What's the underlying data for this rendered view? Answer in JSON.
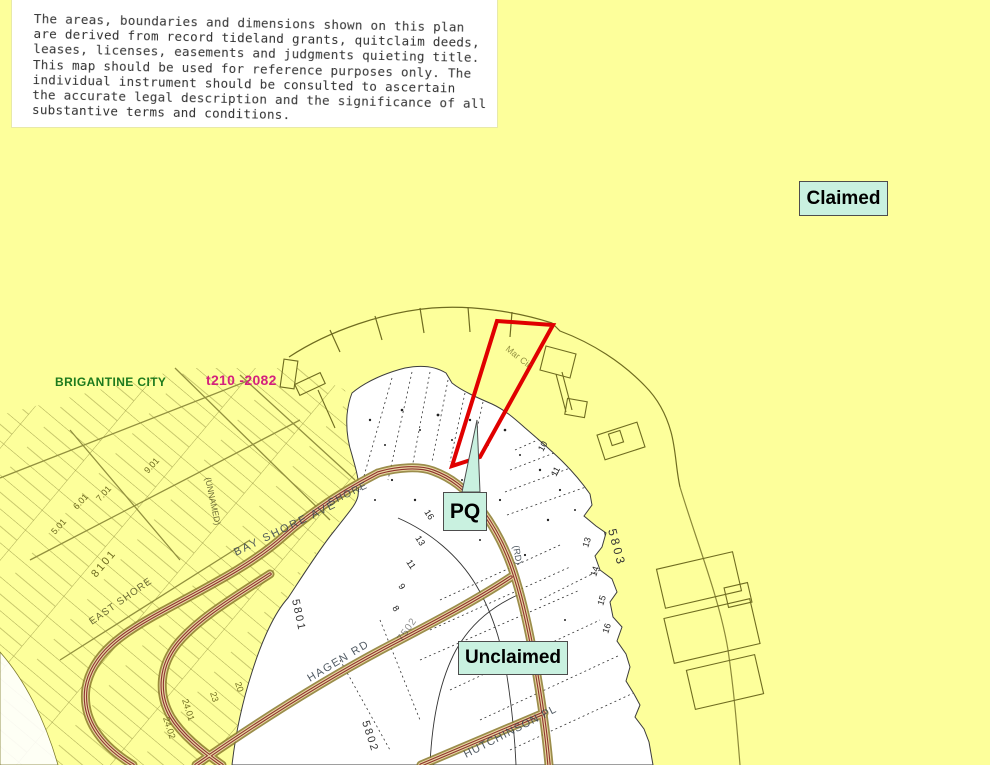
{
  "disclaimer": {
    "lines": [
      "The areas, boundaries and dimensions shown on this plan",
      "are derived from record tideland grants, quitclaim deeds,",
      "leases, licenses, easements and judgments quieting title.",
      "This map should be used for reference purposes only.  The",
      "individual instrument should be consulted to ascertain",
      "the accurate legal description and the significance of all",
      "substantive terms and conditions."
    ]
  },
  "annotations": {
    "claimed": "Claimed",
    "unclaimed": "Unclaimed",
    "pq": "PQ"
  },
  "header": {
    "municipality": "BRIGANTINE CITY",
    "claim_ref": "t210 -2082"
  },
  "streets": {
    "bay_shore": "BAY SHORE AVE",
    "shore": "SHORE",
    "east_shore": "EAST SHORE",
    "hagen": "HAGEN RD",
    "hutchinson": "HUTCHINSON PL",
    "unnamed": "(UNNAMED)",
    "rd": "(RD)"
  },
  "blocks": {
    "b8101": "8101",
    "b5801": "5801",
    "b5802": "5802",
    "b5803": "5803",
    "b7502": "7502"
  },
  "lots": [
    "5.01",
    "6.01",
    "7.01",
    "9.01",
    "8",
    "9",
    "10",
    "11",
    "13",
    "14",
    "15",
    "16",
    "20",
    "23",
    "24.01",
    "24.02"
  ],
  "scribbles": {
    "coast_note": "Mar Cir"
  },
  "colors": {
    "claimed_area": "#fdff9b",
    "unclaimed_area": "#ffffff",
    "annotation_bg": "#c9f1e0",
    "claim_outline": "#e00000",
    "road_center": "#8e332e",
    "municipality_text": "#1d7a1d",
    "claim_ref_text": "#d4217d"
  }
}
